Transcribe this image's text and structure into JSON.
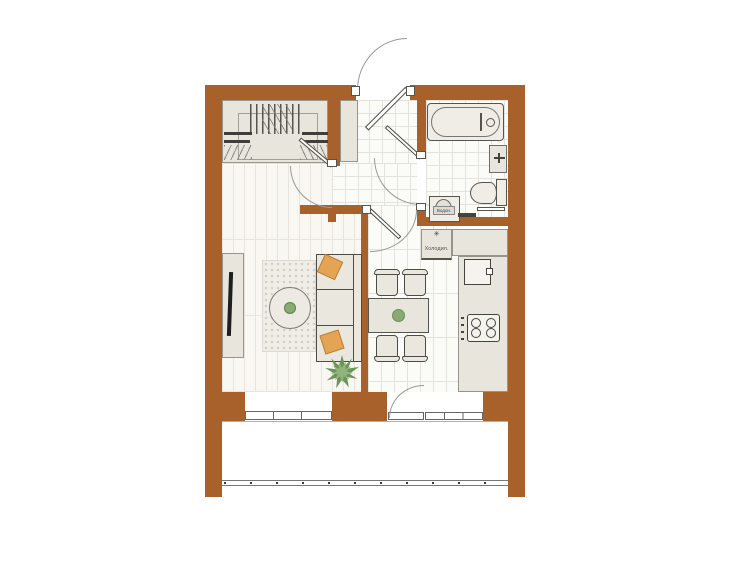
{
  "title": "one-room apartment floor plan",
  "colors": {
    "wall": "#a8612a",
    "cabinet": "#e7e5dc",
    "fixture": "#efede6",
    "tileLine": "#e3e3db",
    "plankLine": "#e6e4dc",
    "rug": "#efede6",
    "accentPillow": "#e5a455",
    "plantDark": "#6b9459",
    "plantLight": "#8fb47a"
  },
  "labels": {
    "fridge_icon": "✳",
    "fridge": "Холодил.",
    "washer": "Водон."
  }
}
